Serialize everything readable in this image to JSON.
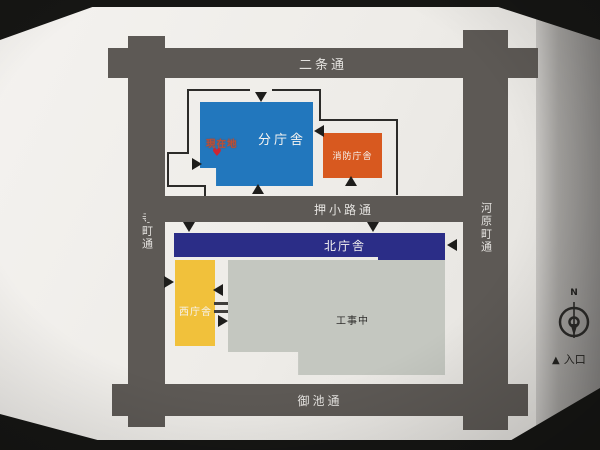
{
  "streets": {
    "north": "二条通",
    "middle": "押小路通",
    "south": "御池通",
    "west": "寺町通",
    "east": "河原町通"
  },
  "buildings": {
    "branch": "分庁舎",
    "fire_station": "消防庁舎",
    "north": "北庁舎",
    "west": "西庁舎",
    "construction_site": "工事中"
  },
  "marker": {
    "label": "現在地",
    "symbol": "♥"
  },
  "compass": {
    "north_label": "N"
  },
  "legend": {
    "entrance_symbol": "▲",
    "entrance_label": "入口"
  },
  "colors": {
    "street": "#5d5955",
    "branch_building": "#2277bd",
    "fire_station_building": "#d8591f",
    "north_building": "#2b2d87",
    "west_building": "#f1c13b",
    "construction_area": "#c4c7c0",
    "marker_red": "#cc2633"
  }
}
